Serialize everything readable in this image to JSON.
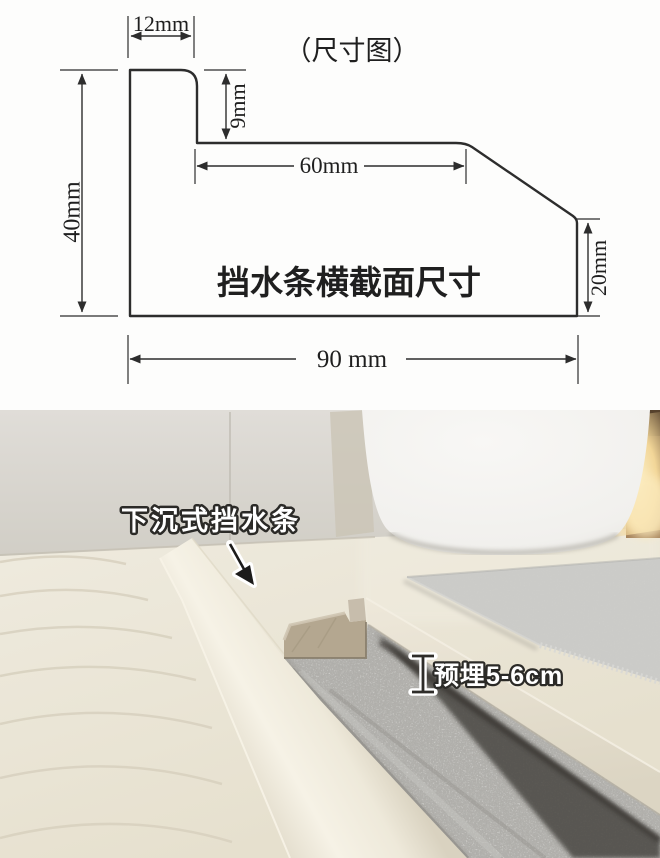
{
  "diagram": {
    "title": "（尺寸图）",
    "caption": "挡水条横截面尺寸",
    "line_color": "#2d2d2d",
    "dims": {
      "top_width": "12mm",
      "step_height": "9mm",
      "shelf_width": "60mm",
      "left_height": "40mm",
      "right_height": "20mm",
      "bottom_width": "90 mm"
    }
  },
  "photo": {
    "strip_label": "下沉式挡水条",
    "embed_label": "预埋5-6cm",
    "colors": {
      "wall": "#d9d6d0",
      "floor": "#ebe6d8",
      "tub": "#f4f3f1",
      "mat": "#cbcbc8",
      "concrete": "#b3b2ae",
      "slot_dark": "#4a4742",
      "glow": "#f2d698",
      "cut_face": "#b4a790",
      "cut_lip": "#c7bdac"
    }
  }
}
